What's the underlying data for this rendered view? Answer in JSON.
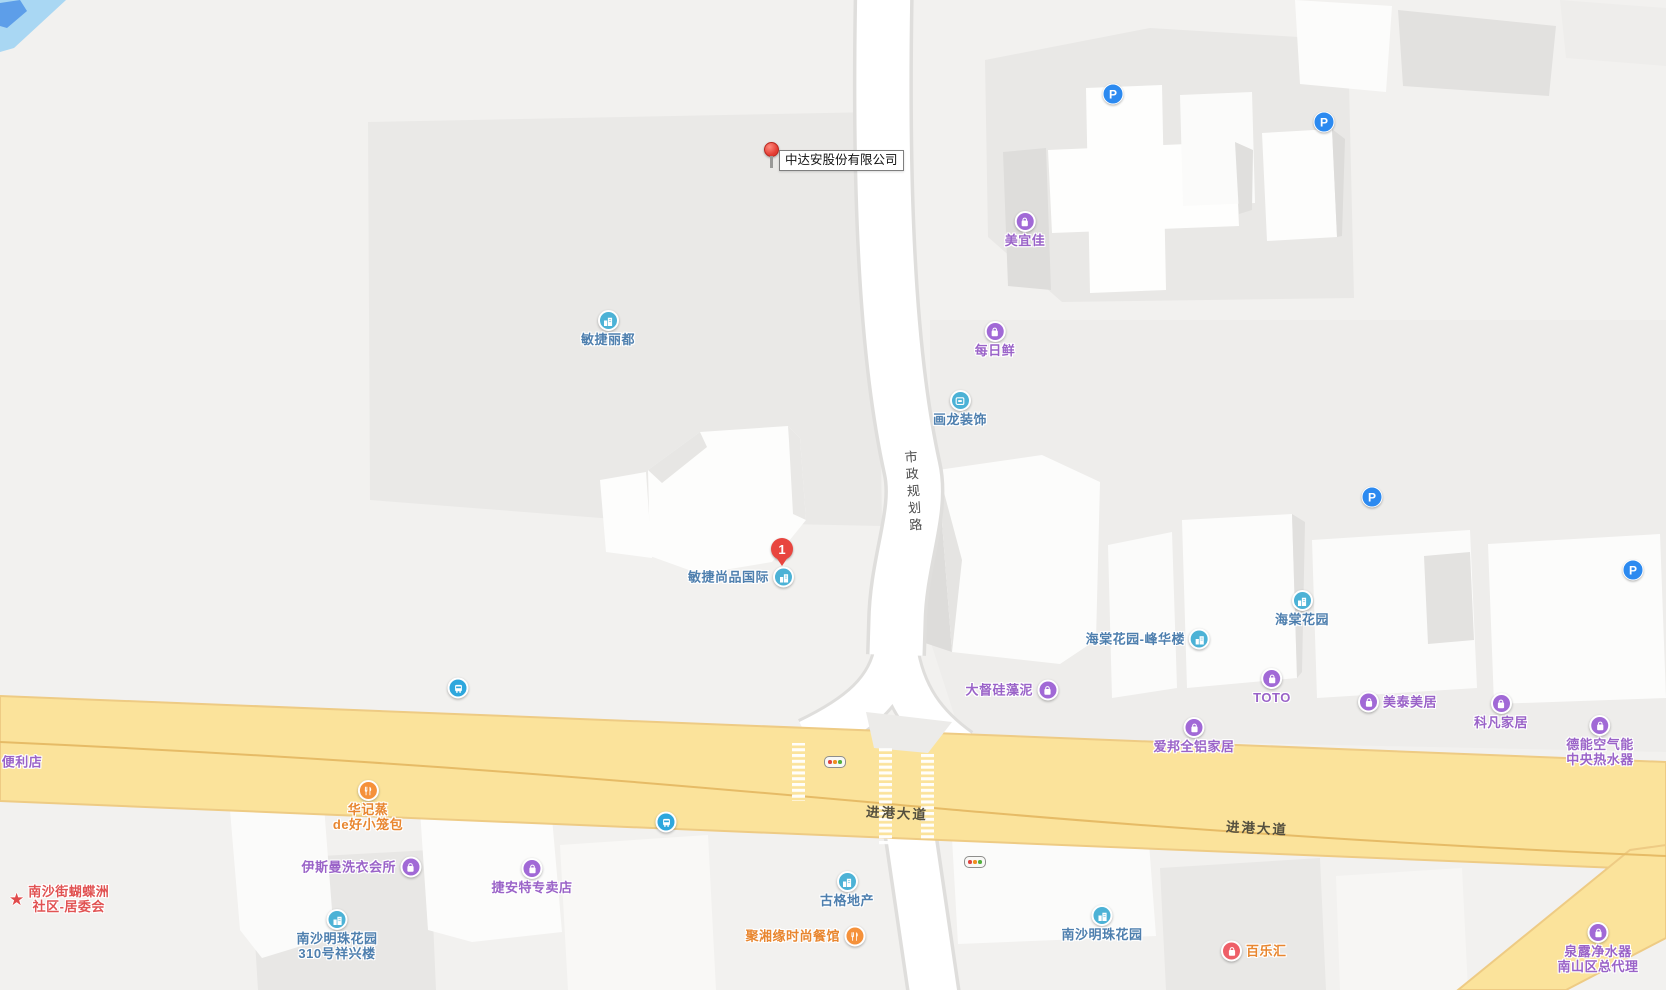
{
  "map": {
    "pin": {
      "label": "中达安股份有限公司"
    },
    "numbered_marker": {
      "number": "1"
    },
    "road_labels": [
      {
        "id": "shizheng-guihua-rd",
        "text": "市政规划路",
        "orientation": "vertical",
        "x": 903,
        "y": 450
      },
      {
        "id": "jingang-ave-west",
        "text": "进港大道",
        "orientation": "horizontal",
        "x": 866,
        "y": 802
      },
      {
        "id": "jingang-ave-east",
        "text": "进港大道",
        "orientation": "horizontal",
        "x": 1226,
        "y": 817
      }
    ],
    "pois": [
      {
        "id": "minjie-lidu",
        "name": "敏捷丽都",
        "type": "building",
        "color": "blue",
        "layout": "icon-top",
        "x": 608,
        "y": 321
      },
      {
        "id": "meiyijia",
        "name": "美宜佳",
        "type": "bag",
        "color": "purple",
        "layout": "icon-top",
        "x": 1025,
        "y": 222
      },
      {
        "id": "meirixian",
        "name": "每日鲜",
        "type": "bag",
        "color": "purple",
        "layout": "icon-top",
        "x": 995,
        "y": 332
      },
      {
        "id": "hualong-zhuangshi",
        "name": "画龙装饰",
        "type": "sign",
        "color": "blue",
        "layout": "icon-top",
        "x": 960,
        "y": 401
      },
      {
        "id": "minjie-shangpin-intl",
        "name": "敏捷尚品国际",
        "type": "building",
        "color": "blue",
        "layout": "icon-right",
        "x": 782,
        "y": 577,
        "marker": true
      },
      {
        "id": "haitang-fenghualou",
        "name": "海棠花园-峰华楼",
        "type": "building",
        "color": "blue",
        "layout": "icon-right",
        "x": 1198,
        "y": 639
      },
      {
        "id": "haitang-huayuan",
        "name": "海棠花园",
        "type": "building",
        "color": "blue",
        "layout": "icon-top",
        "x": 1302,
        "y": 601
      },
      {
        "id": "dadu-guizaoni",
        "name": "大督硅藻泥",
        "type": "bag",
        "color": "purple",
        "layout": "icon-right",
        "x": 1046,
        "y": 690
      },
      {
        "id": "toto",
        "name": "TOTO",
        "type": "bag",
        "color": "purple",
        "layout": "icon-top",
        "x": 1272,
        "y": 679
      },
      {
        "id": "meitai-meiju",
        "name": "美泰美居",
        "type": "bag",
        "color": "purple",
        "layout": "icon-left",
        "x": 1369,
        "y": 702
      },
      {
        "id": "kefan-jiaju",
        "name": "科凡家居",
        "type": "bag",
        "color": "purple",
        "layout": "icon-top",
        "x": 1501,
        "y": 704
      },
      {
        "id": "deneng",
        "name": "德能空气能",
        "name2": "中央热水器",
        "type": "bag",
        "color": "purple",
        "layout": "icon-top",
        "x": 1600,
        "y": 726
      },
      {
        "id": "aibang",
        "name": "爱邦全铝家居",
        "type": "bag",
        "color": "purple",
        "layout": "icon-top",
        "x": 1194,
        "y": 728
      },
      {
        "id": "bianlidian",
        "name": "便利店",
        "type": "none",
        "color": "purple",
        "layout": "text-only",
        "x": 22,
        "y": 762
      },
      {
        "id": "huajizheng",
        "name": "华记蒸",
        "name2": "de好小笼包",
        "type": "food",
        "color": "orange",
        "layout": "icon-top",
        "x": 368,
        "y": 791
      },
      {
        "id": "nansha-community",
        "name": "南沙街蝴蝶洲",
        "name2": "社区-居委会",
        "type": "star",
        "color": "red",
        "layout": "icon-left",
        "x": 20,
        "y": 899
      },
      {
        "id": "yisiman-laundry",
        "name": "伊斯曼洗衣会所",
        "type": "bag",
        "color": "purple",
        "layout": "icon-right",
        "x": 409,
        "y": 867
      },
      {
        "id": "jieante",
        "name": "捷安特专卖店",
        "type": "bag",
        "color": "purple",
        "layout": "icon-top",
        "x": 532,
        "y": 869
      },
      {
        "id": "guge-dichan",
        "name": "古格地产",
        "type": "building",
        "color": "blue",
        "layout": "icon-top",
        "x": 847,
        "y": 882
      },
      {
        "id": "juxiangyuan",
        "name": "聚湘缘时尚餐馆",
        "type": "food",
        "color": "orange",
        "layout": "icon-right",
        "x": 853,
        "y": 936
      },
      {
        "id": "nansha-mingzhu-310",
        "name": "南沙明珠花园",
        "name2": "310号祥兴楼",
        "type": "building",
        "color": "blue",
        "layout": "icon-top",
        "x": 337,
        "y": 920
      },
      {
        "id": "nansha-mingzhu",
        "name": "南沙明珠花园",
        "type": "building",
        "color": "blue",
        "layout": "icon-top",
        "x": 1102,
        "y": 916
      },
      {
        "id": "bailehui",
        "name": "百乐汇",
        "type": "bag",
        "color": "pink",
        "layout": "icon-left",
        "x": 1232,
        "y": 951
      },
      {
        "id": "quanlu-water",
        "name": "泉露净水器",
        "name2": "南山区总代理",
        "type": "bag",
        "color": "purple",
        "layout": "icon-top",
        "x": 1598,
        "y": 933
      }
    ],
    "parking_icons": [
      {
        "x": 1113,
        "y": 94
      },
      {
        "x": 1324,
        "y": 122
      },
      {
        "x": 1372,
        "y": 497
      },
      {
        "x": 1633,
        "y": 570
      }
    ],
    "bus_stops": [
      {
        "x": 458,
        "y": 688
      },
      {
        "x": 666,
        "y": 822
      }
    ],
    "traffic_lights": [
      {
        "x": 835,
        "y": 762
      },
      {
        "x": 975,
        "y": 862
      }
    ],
    "colors": {
      "blue": "#4cb2d6",
      "purple": "#a169d6",
      "orange": "#f5913a",
      "pink": "#ee5f68",
      "red": "#e14b4b",
      "bus": "#2ea7dd",
      "parking": "#2c8af0",
      "highway_fill": "#fbe39b",
      "water": "#a9d7f3",
      "pin_red": "#e33b32"
    }
  }
}
